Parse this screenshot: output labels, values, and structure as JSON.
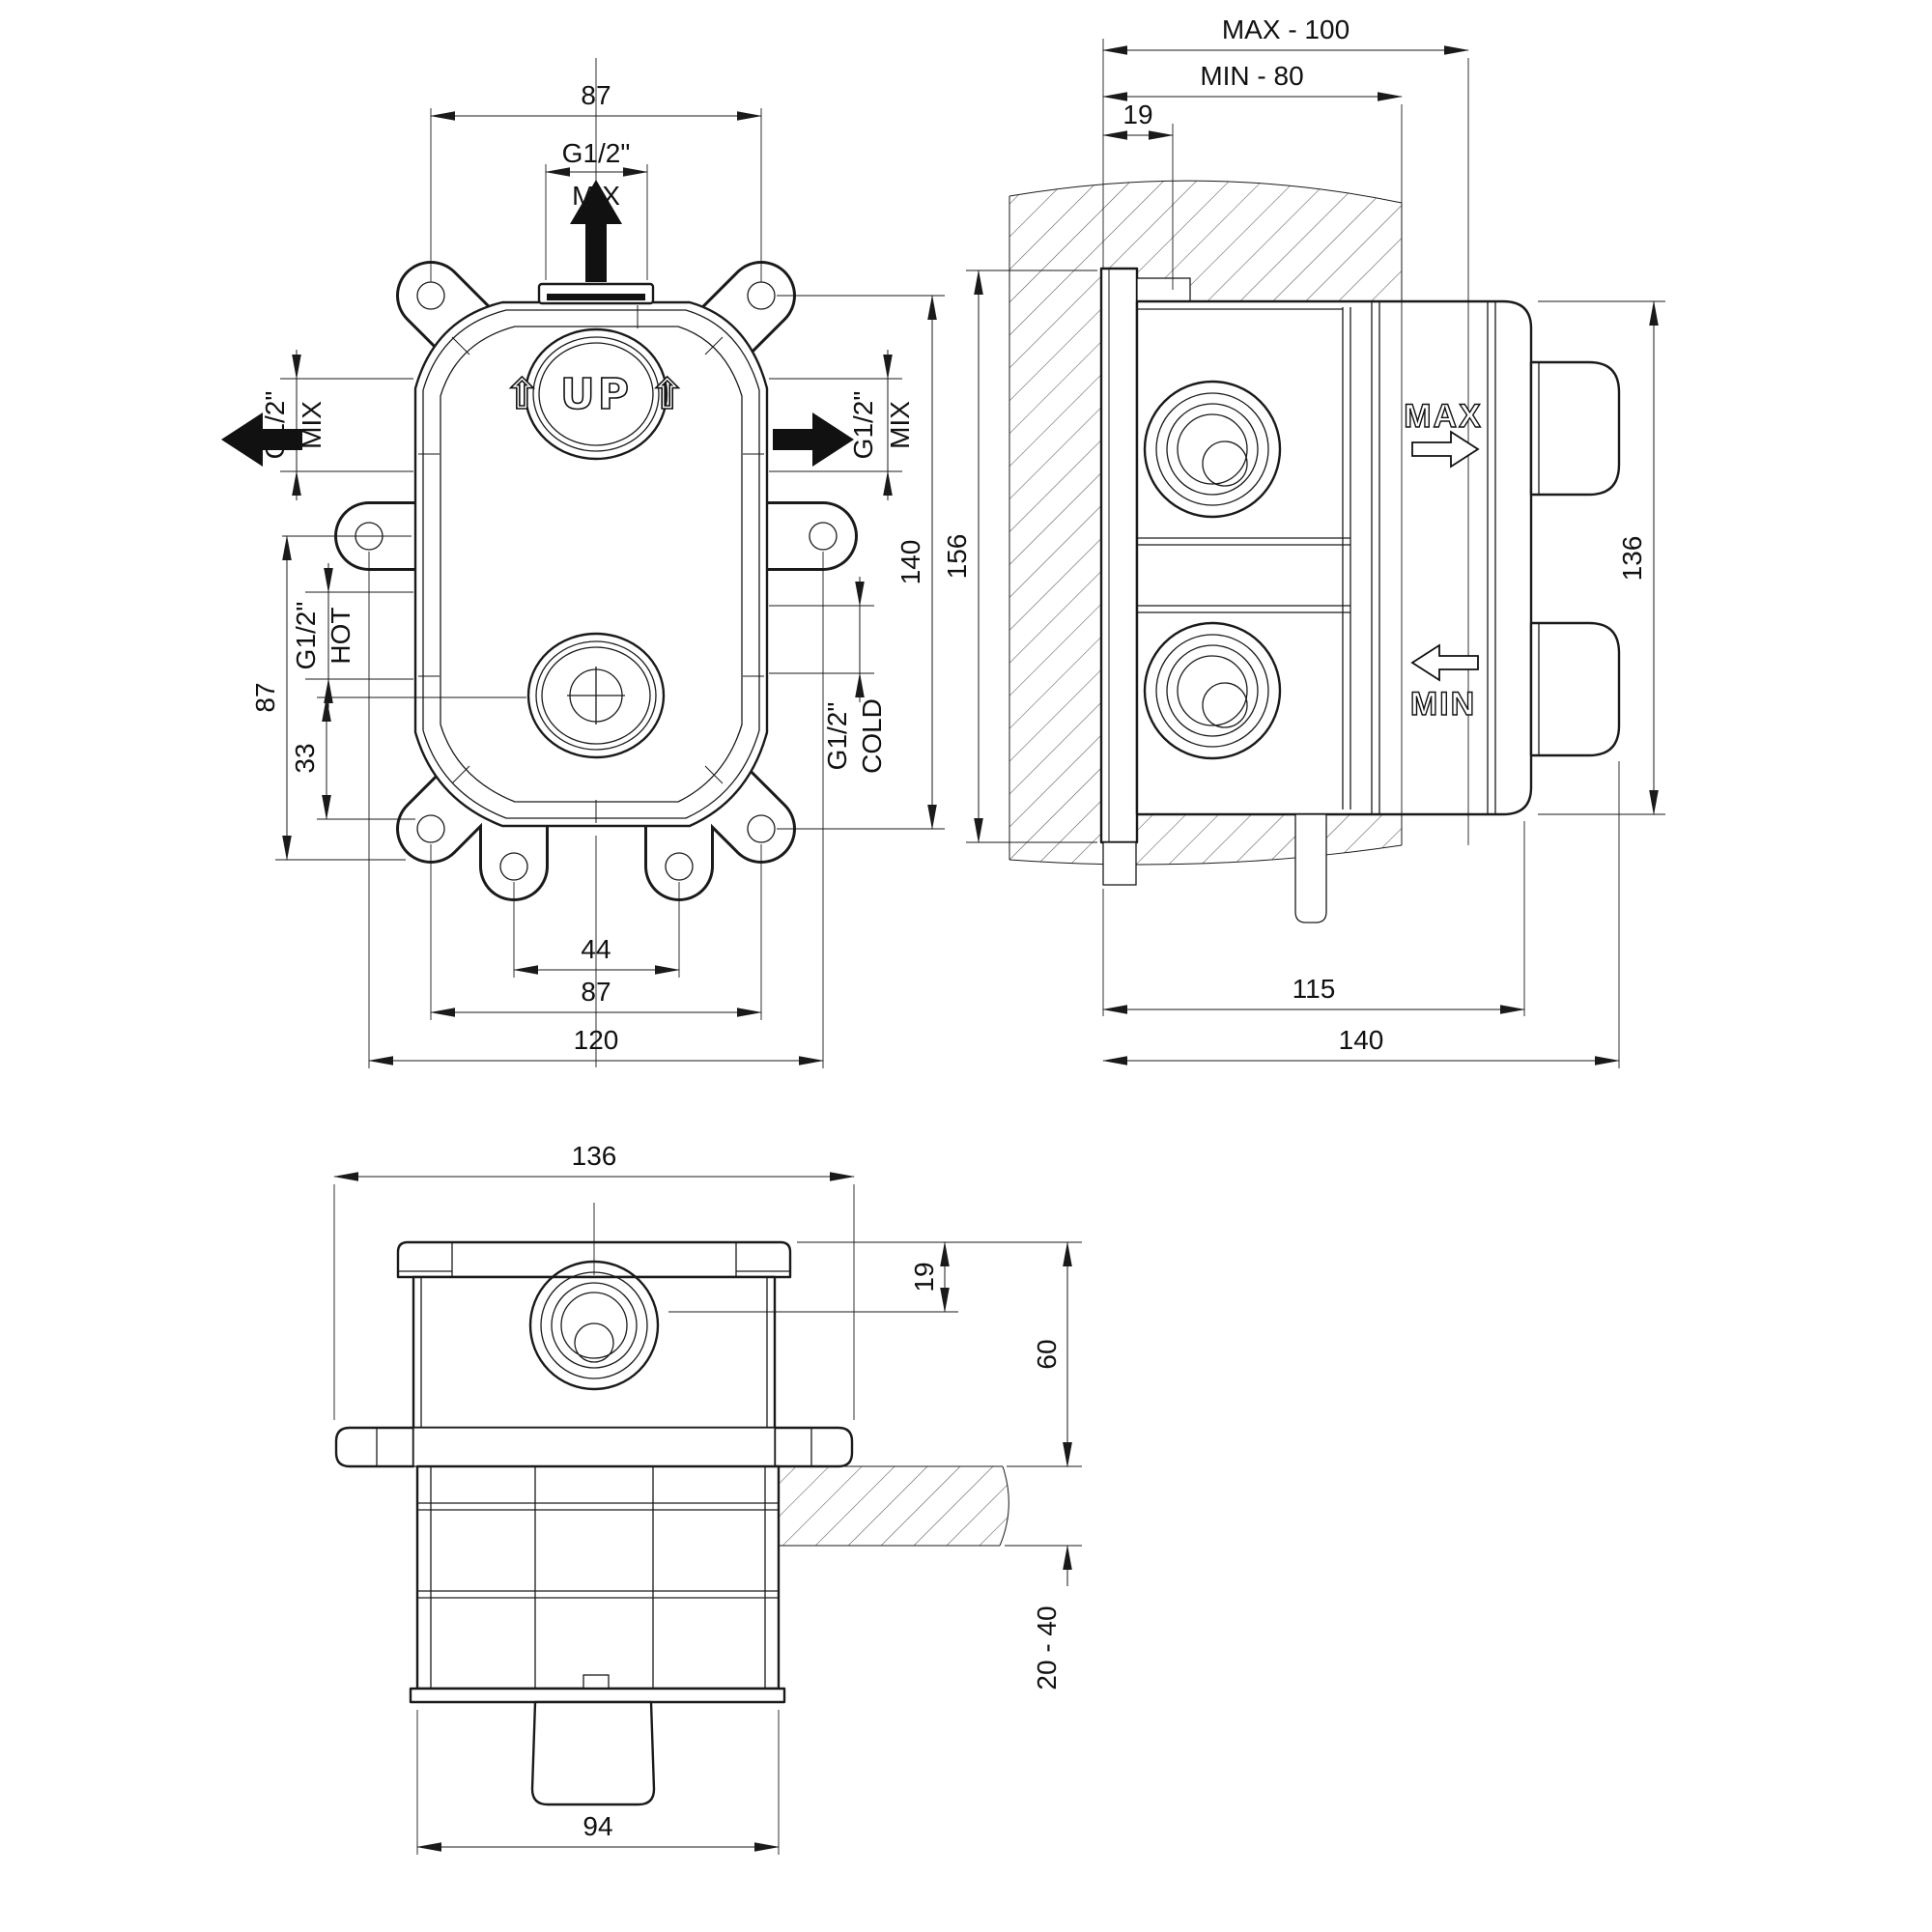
{
  "drawing_type": "installation technical drawing, concealed mixer valve rough-in box, three orthographic views",
  "colors": {
    "line": "#1a1a1a",
    "background": "#ffffff"
  },
  "views": {
    "front": {
      "name": "front view",
      "marking_up": "⇧ UP ⇧",
      "dims": {
        "top_width": "87",
        "top_port_size": "G1/2\"",
        "top_port_flow": "MIX",
        "left_port_size": "G1/2\"",
        "left_port_flow": "MIX",
        "hot_port_size": "G1/2\"",
        "hot_port_flow": "HOT",
        "left_span": "87",
        "lower_offset": "33",
        "right_port_size": "G1/2\"",
        "right_port_flow": "MIX",
        "cold_port_size": "G1/2\"",
        "cold_port_flow": "COLD",
        "mount_height": "140",
        "bottom_ear_gap": "44",
        "bottom_ear_span": "87",
        "overall_width": "120"
      }
    },
    "side": {
      "name": "side section view",
      "marking_max": "MAX",
      "marking_min": "MIN",
      "dims": {
        "max_depth": "MAX - 100",
        "min_depth": "MIN - 80",
        "flange_inset": "19",
        "flange_height": "156",
        "body_height": "136",
        "body_depth": "115",
        "overall_depth": "140"
      }
    },
    "bottom": {
      "name": "top view",
      "dims": {
        "body_width": "136",
        "flange_inset": "19",
        "in_wall_depth": "60",
        "wall_thickness": "20 - 40",
        "spout_width": "94"
      }
    }
  }
}
